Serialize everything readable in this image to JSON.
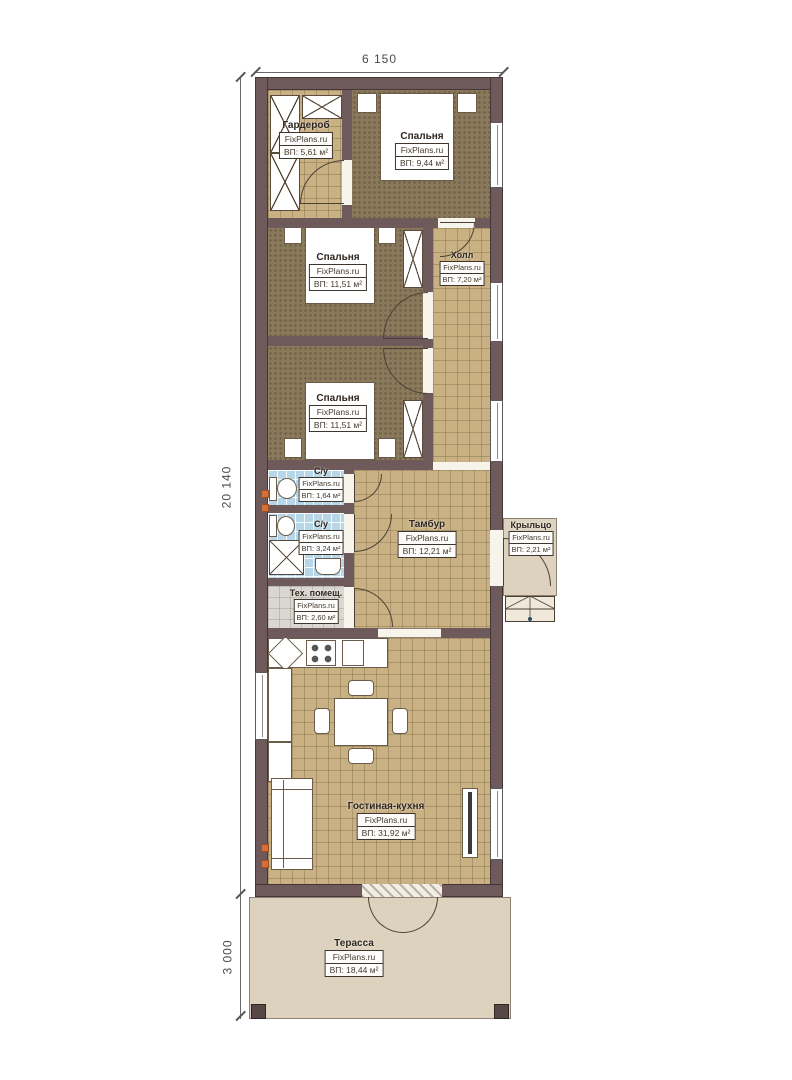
{
  "brand": "FixPlans.ru",
  "dims": {
    "top": "6 150",
    "left_main": "20 140",
    "left_terrace": "3 000"
  },
  "rooms": {
    "wardrobe": {
      "name": "Гардероб",
      "brand": "FixPlans.ru",
      "area": "ВП: 5,61 м²"
    },
    "bedroom1": {
      "name": "Спальня",
      "brand": "FixPlans.ru",
      "area": "ВП: 9,44 м²"
    },
    "bedroom2": {
      "name": "Спальня",
      "brand": "FixPlans.ru",
      "area": "ВП: 11,51 м²"
    },
    "hall": {
      "name": "Холл",
      "brand": "FixPlans.ru",
      "area": "ВП: 7,20 м²"
    },
    "bedroom3": {
      "name": "Спальня",
      "brand": "FixPlans.ru",
      "area": "ВП: 11,51 м²"
    },
    "wc1": {
      "name": "С/у",
      "brand": "FixPlans.ru",
      "area": "ВП: 1,64 м²"
    },
    "wc2": {
      "name": "С/у",
      "brand": "FixPlans.ru",
      "area": "ВП: 3,24 м²"
    },
    "tambour": {
      "name": "Тамбур",
      "brand": "FixPlans.ru",
      "area": "ВП: 12,21 м²"
    },
    "porch": {
      "name": "Крыльцо",
      "brand": "FixPlans.ru",
      "area": "ВП: 2,21 м²"
    },
    "tech": {
      "name": "Тех. помещ.",
      "brand": "FixPlans.ru",
      "area": "ВП: 2,60 м²"
    },
    "living": {
      "name": "Гостиная-кухня",
      "brand": "FixPlans.ru",
      "area": "ВП: 31,92 м²"
    },
    "terrace": {
      "name": "Терасса",
      "brand": "FixPlans.ru",
      "area": "ВП: 18,44 м²"
    }
  },
  "colors": {
    "wall": "#6e5a5a",
    "wall_outline": "#443636",
    "tile": "#c9b184",
    "carpet": "#8b795b",
    "bath_tile": "#b7d7e8",
    "tech_tile": "#d9d7cf",
    "deck": "#dcd2be",
    "vent_accent": "#d2703b"
  }
}
